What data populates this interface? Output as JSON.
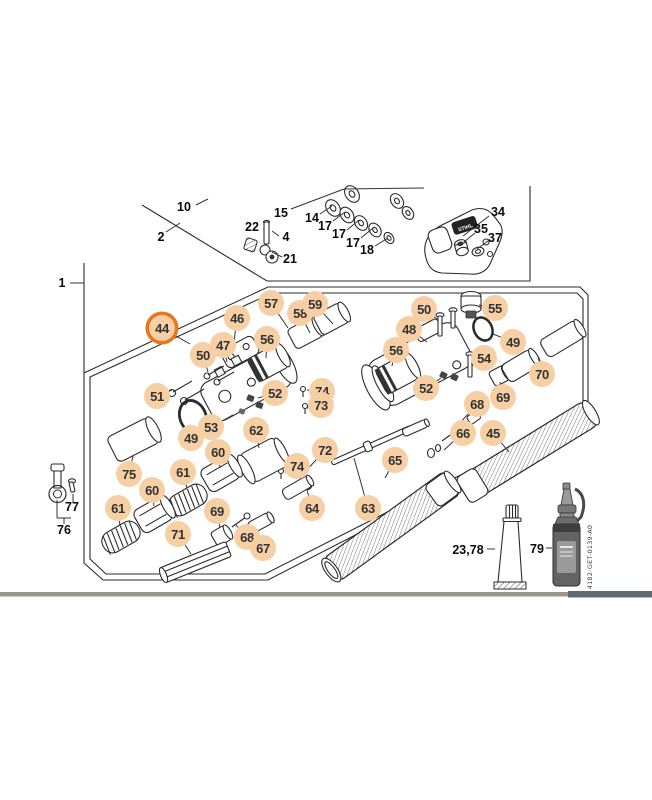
{
  "diagram": {
    "accent_orange": "#e8761d",
    "callout_fill": "#f6cfa4",
    "doc_number": "4182-GET-0139-A0",
    "brand_text": "STIHL",
    "bottom_bar": {
      "left_color": "#9b9786",
      "right_color": "#5d6a75"
    },
    "plain_labels": [
      {
        "text": "1",
        "x": 62,
        "y": 283
      },
      {
        "text": "10",
        "x": 184,
        "y": 207
      },
      {
        "text": "2",
        "x": 161,
        "y": 237
      },
      {
        "text": "22",
        "x": 252,
        "y": 227
      },
      {
        "text": "4",
        "x": 286,
        "y": 237
      },
      {
        "text": "21",
        "x": 290,
        "y": 259
      },
      {
        "text": "15",
        "x": 281,
        "y": 213
      },
      {
        "text": "14",
        "x": 312,
        "y": 218
      },
      {
        "text": "17",
        "x": 325,
        "y": 226
      },
      {
        "text": "17",
        "x": 339,
        "y": 234
      },
      {
        "text": "17",
        "x": 353,
        "y": 243
      },
      {
        "text": "18",
        "x": 367,
        "y": 250
      },
      {
        "text": "34",
        "x": 498,
        "y": 212
      },
      {
        "text": "35",
        "x": 481,
        "y": 229
      },
      {
        "text": "37",
        "x": 495,
        "y": 238
      },
      {
        "text": "77",
        "x": 72,
        "y": 507
      },
      {
        "text": "76",
        "x": 64,
        "y": 530
      },
      {
        "text": "23,78",
        "x": 468,
        "y": 550
      },
      {
        "text": "79",
        "x": 537,
        "y": 549
      }
    ],
    "callouts": [
      {
        "label": "44",
        "cx": 162,
        "cy": 328,
        "lx": 190,
        "ly": 344,
        "highlighted": true
      },
      {
        "label": "46",
        "cx": 237,
        "cy": 318,
        "lx": 233,
        "ly": 350
      },
      {
        "label": "47",
        "cx": 223,
        "cy": 345,
        "lx": 227,
        "ly": 362
      },
      {
        "label": "50",
        "cx": 203,
        "cy": 355,
        "lx": 208,
        "ly": 372
      },
      {
        "label": "57",
        "cx": 271,
        "cy": 303,
        "lx": 288,
        "ly": 328
      },
      {
        "label": "58",
        "cx": 300,
        "cy": 313,
        "lx": 310,
        "ly": 333
      },
      {
        "label": "59",
        "cx": 315,
        "cy": 304,
        "lx": 333,
        "ly": 324
      },
      {
        "label": "56",
        "cx": 267,
        "cy": 339,
        "lx": 266,
        "ly": 358
      },
      {
        "label": "51",
        "cx": 157,
        "cy": 396,
        "lx": 172,
        "ly": 390
      },
      {
        "label": "52",
        "cx": 275,
        "cy": 393,
        "lx": 258,
        "ly": 398
      },
      {
        "label": "53",
        "cx": 211,
        "cy": 427,
        "lx": 233,
        "ly": 415
      },
      {
        "label": "49",
        "cx": 191,
        "cy": 438,
        "lx": 202,
        "ly": 424
      },
      {
        "label": "62",
        "cx": 256,
        "cy": 430,
        "lx": 259,
        "ly": 448
      },
      {
        "label": "74",
        "cx": 322,
        "cy": 391,
        "lx": 307,
        "ly": 390
      },
      {
        "label": "73",
        "cx": 321,
        "cy": 405,
        "lx": 307,
        "ly": 408
      },
      {
        "label": "50",
        "cx": 424,
        "cy": 309,
        "lx": 437,
        "ly": 319
      },
      {
        "label": "55",
        "cx": 495,
        "cy": 308,
        "lx": 479,
        "ly": 305
      },
      {
        "label": "48",
        "cx": 409,
        "cy": 329,
        "lx": 427,
        "ly": 342
      },
      {
        "label": "49",
        "cx": 513,
        "cy": 342,
        "lx": 493,
        "ly": 334
      },
      {
        "label": "56",
        "cx": 396,
        "cy": 350,
        "lx": 392,
        "ly": 366
      },
      {
        "label": "54",
        "cx": 484,
        "cy": 358,
        "lx": 472,
        "ly": 366
      },
      {
        "label": "52",
        "cx": 426,
        "cy": 388,
        "lx": 441,
        "ly": 378
      },
      {
        "label": "70",
        "cx": 542,
        "cy": 374,
        "lx": 538,
        "ly": 356
      },
      {
        "label": "69",
        "cx": 503,
        "cy": 397,
        "lx": 500,
        "ly": 382
      },
      {
        "label": "68",
        "cx": 477,
        "cy": 404,
        "lx": 459,
        "ly": 424
      },
      {
        "label": "66",
        "cx": 463,
        "cy": 433,
        "lx": 444,
        "ly": 450
      },
      {
        "label": "45",
        "cx": 493,
        "cy": 433,
        "lx": 509,
        "ly": 452
      },
      {
        "label": "72",
        "cx": 325,
        "cy": 450,
        "lx": 305,
        "ly": 472
      },
      {
        "label": "74",
        "cx": 297,
        "cy": 466,
        "lx": 285,
        "ly": 472
      },
      {
        "label": "64",
        "cx": 312,
        "cy": 508,
        "lx": 307,
        "ly": 490
      },
      {
        "label": "65",
        "cx": 395,
        "cy": 460,
        "lx": 385,
        "ly": 478
      },
      {
        "label": "63",
        "cx": 368,
        "cy": 508,
        "lx": 354,
        "ly": 458
      },
      {
        "label": "75",
        "cx": 129,
        "cy": 474,
        "lx": 133,
        "ly": 456
      },
      {
        "label": "60",
        "cx": 218,
        "cy": 452,
        "lx": 220,
        "ly": 468
      },
      {
        "label": "61",
        "cx": 183,
        "cy": 472,
        "lx": 187,
        "ly": 488
      },
      {
        "label": "60",
        "cx": 152,
        "cy": 490,
        "lx": 154,
        "ly": 506
      },
      {
        "label": "61",
        "cx": 118,
        "cy": 508,
        "lx": 120,
        "ly": 526
      },
      {
        "label": "69",
        "cx": 217,
        "cy": 511,
        "lx": 220,
        "ly": 528
      },
      {
        "label": "71",
        "cx": 178,
        "cy": 534,
        "lx": 191,
        "ly": 554
      },
      {
        "label": "68",
        "cx": 247,
        "cy": 537,
        "lx": 235,
        "ly": 524
      },
      {
        "label": "67",
        "cx": 263,
        "cy": 548,
        "lx": 245,
        "ly": 532
      }
    ],
    "leader_lines": [
      [
        70,
        283,
        84,
        283
      ],
      [
        196,
        205,
        208,
        199
      ],
      [
        166,
        232,
        180,
        223
      ],
      [
        291,
        209,
        344,
        189
      ],
      [
        344,
        189,
        424,
        188
      ],
      [
        320,
        214,
        332,
        206
      ],
      [
        333,
        221,
        345,
        212
      ],
      [
        347,
        230,
        359,
        220
      ],
      [
        361,
        238,
        373,
        228
      ],
      [
        375,
        246,
        388,
        238
      ],
      [
        489,
        216,
        463,
        236
      ],
      [
        475,
        233,
        464,
        242
      ],
      [
        488,
        241,
        477,
        249
      ],
      [
        282,
        257,
        272,
        252
      ],
      [
        279,
        236,
        272,
        231
      ],
      [
        57,
        500,
        57,
        518
      ],
      [
        57,
        518,
        71,
        518
      ],
      [
        64,
        518,
        64,
        524
      ],
      [
        73,
        494,
        73,
        502
      ],
      [
        487,
        549,
        495,
        549
      ],
      [
        546,
        548,
        552,
        548
      ]
    ]
  }
}
